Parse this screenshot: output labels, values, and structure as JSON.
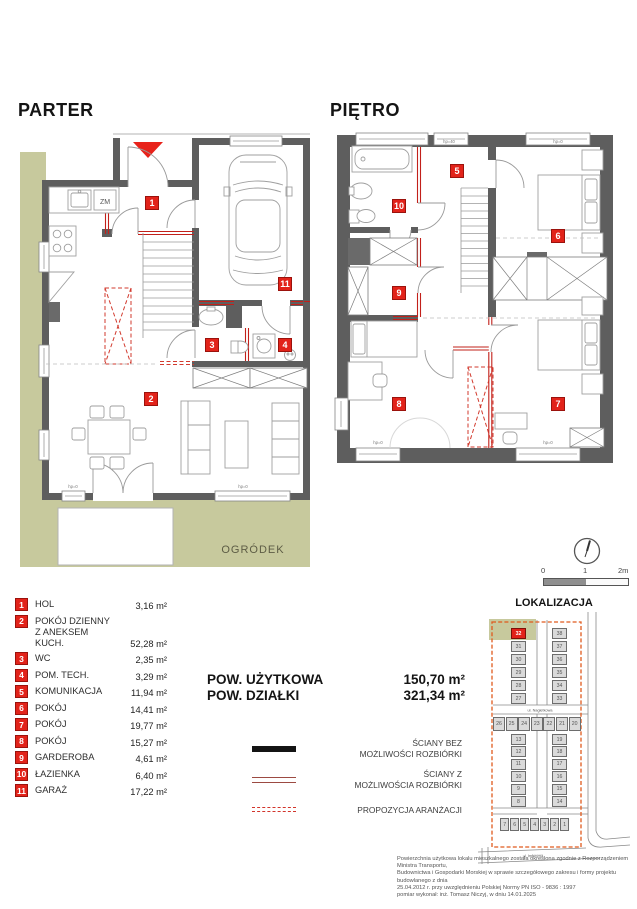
{
  "plans": {
    "parter": {
      "title": "PARTER",
      "garden_label": "OGRÓDEK",
      "kitchen_label": "ZM",
      "badges": [
        "1",
        "2",
        "3",
        "4",
        "11"
      ],
      "window_labels": [
        "hp=0",
        "hp=0"
      ]
    },
    "pietro": {
      "title": "PIĘTRO",
      "badges": [
        "5",
        "6",
        "7",
        "8",
        "9",
        "10"
      ],
      "window_labels": [
        "hp=40",
        "hp=0",
        "hp=0",
        "hp=0"
      ]
    }
  },
  "legend": {
    "rooms": [
      {
        "num": "1",
        "name": "HOL",
        "area": "3,16 m²"
      },
      {
        "num": "2",
        "name": "POKÓJ DZIENNY",
        "name2": "Z ANEKSEM KUCH.",
        "area": "52,28 m²"
      },
      {
        "num": "3",
        "name": "WC",
        "area": "2,35 m²"
      },
      {
        "num": "4",
        "name": "POM. TECH.",
        "area": "3,29 m²"
      },
      {
        "num": "5",
        "name": "KOMUNIKACJA",
        "area": "11,94 m²"
      },
      {
        "num": "6",
        "name": "POKÓJ",
        "area": "14,41 m²"
      },
      {
        "num": "7",
        "name": "POKÓJ",
        "area": "19,77 m²"
      },
      {
        "num": "8",
        "name": "POKÓJ",
        "area": "15,27 m²"
      },
      {
        "num": "9",
        "name": "GARDEROBA",
        "area": "4,61 m²"
      },
      {
        "num": "10",
        "name": "ŁAZIENKA",
        "area": "6,40 m²"
      },
      {
        "num": "11",
        "name": "GARAŻ",
        "area": "17,22 m²"
      }
    ]
  },
  "summary": {
    "rows": [
      {
        "label": "POW. UŻYTKOWA",
        "value": "150,70 m²"
      },
      {
        "label": "POW. DZIAŁKI",
        "value": "321,34 m²"
      }
    ]
  },
  "wall_legend": [
    {
      "type": "solid-black",
      "lines": [
        "ŚCIANY BEZ",
        "MOŻLIWOŚCI ROZBIÓRKI"
      ]
    },
    {
      "type": "double-red",
      "lines": [
        "ŚCIANY Z",
        "MOŻLIWOŚCIA ROZBIÓRKI"
      ]
    },
    {
      "type": "dashed-red",
      "lines": [
        "PROPOZYCJA ARANŻACJI"
      ]
    }
  ],
  "scale_bar": {
    "labels": [
      "0",
      "1",
      "2m"
    ]
  },
  "lokalizacja": {
    "title": "LOKALIZACJA",
    "highlighted_lot": "32",
    "streets": [
      "ul. Nagietkowa",
      "ul. Imbirowa"
    ],
    "groups": {
      "col_top_left": [
        "32",
        "31",
        "30",
        "29",
        "28",
        "27"
      ],
      "col_top_right": [
        "38",
        "37",
        "36",
        "35",
        "34",
        "33"
      ],
      "row_mid": [
        "26",
        "25",
        "24",
        "23",
        "22",
        "21",
        "20"
      ],
      "col_low_left": [
        "13",
        "12",
        "11",
        "10",
        "9",
        "8"
      ],
      "col_low_right": [
        "19",
        "18",
        "17",
        "16",
        "15",
        "14"
      ],
      "row_bottom": [
        "7",
        "6",
        "5",
        "4",
        "3",
        "2",
        "1"
      ]
    }
  },
  "footnote": {
    "lines": [
      "Powierzchnia użytkowa lokalu mieszkalnego została określona zgodnie z Rozporządzeniem Ministra Transportu,",
      "Budownictwa i Gospodarki Morskiej w sprawie szczegółowego zakresu i formy projektu budowlanego z dnia",
      "25.04.2012 r. przy uwzględnieniu Polskiej Normy PN ISO - 9836 : 1997",
      "pomiar wykonał: inż. Tomasz Niczyj, w dniu 14.01.2025"
    ]
  },
  "colors": {
    "badge_red": "#e2231a",
    "wall_gray": "#5e5e5e",
    "garden_olive": "#c7c99d",
    "demolition_red": "#c2201a",
    "boundary_orange": "#e05a1d"
  }
}
